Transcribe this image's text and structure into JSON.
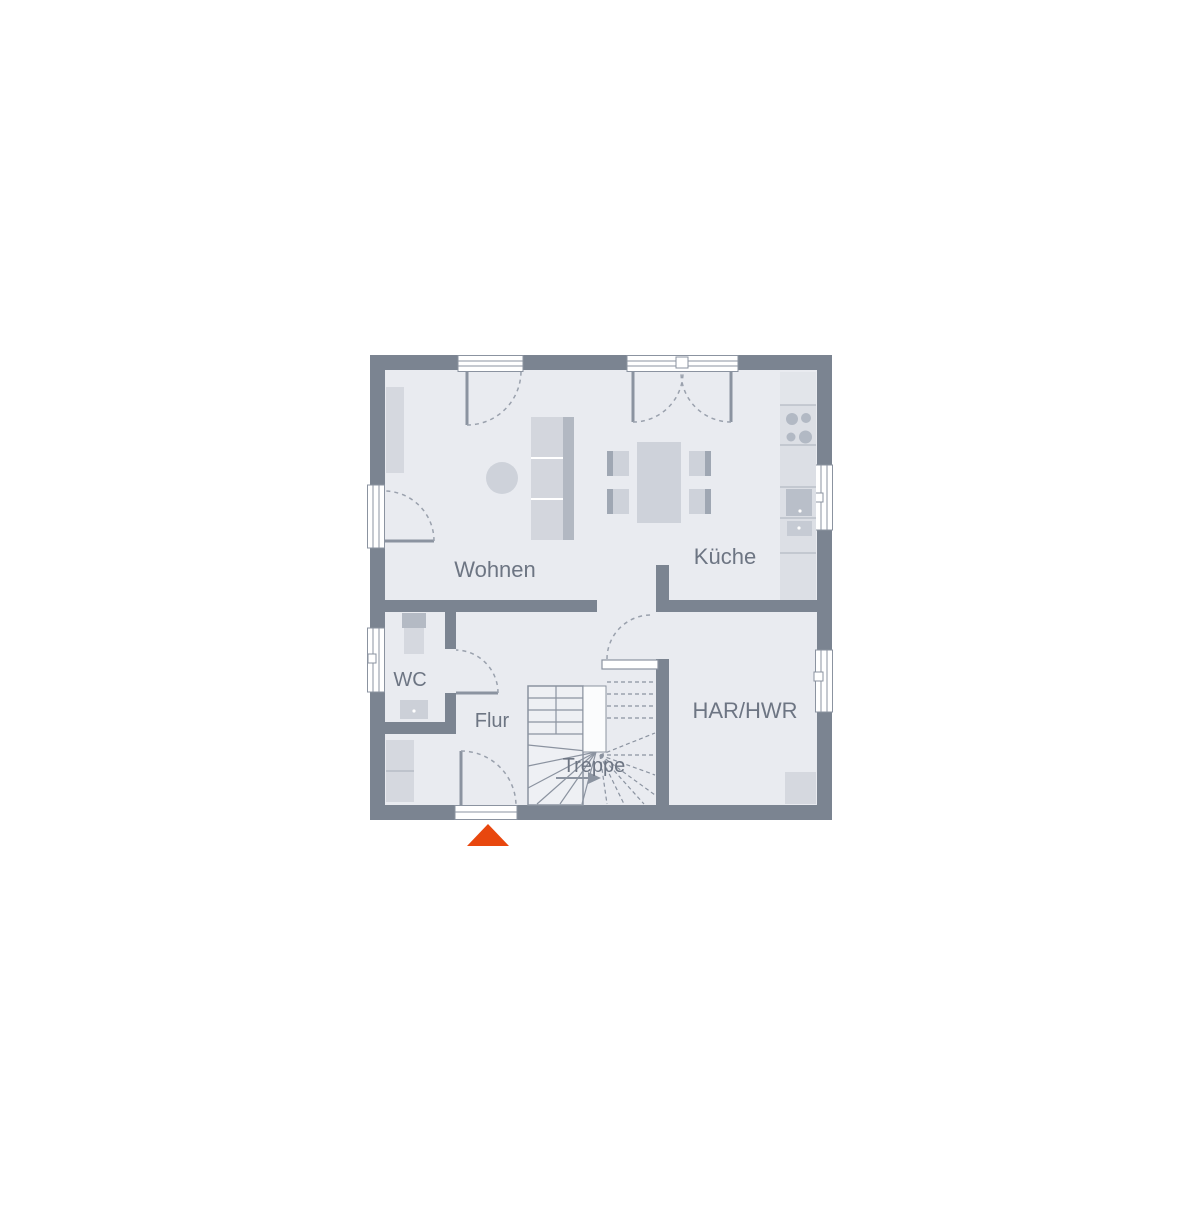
{
  "plan": {
    "rooms": {
      "wohnen": "Wohnen",
      "kueche": "Küche",
      "wc": "WC",
      "flur": "Flur",
      "treppe": "Treppe",
      "har_hwr": "HAR/HWR"
    },
    "colors": {
      "wall": "#7b8491",
      "floor": "#e9ebf0",
      "furniture_light": "#d5d8df",
      "furniture_mid": "#ced2da",
      "fixture_dark": "#b9bfc9",
      "line": "#8b93a0",
      "label_text": "#6d7583",
      "accent_entrance": "#e8470e"
    }
  }
}
